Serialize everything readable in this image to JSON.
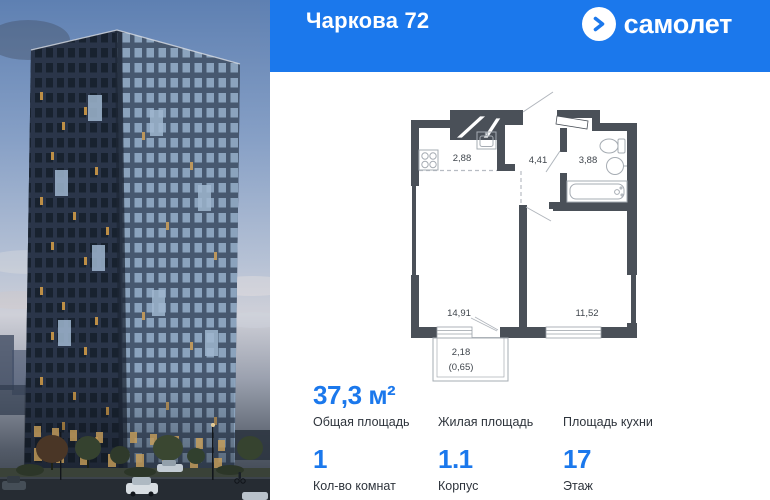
{
  "header": {
    "title": "Чаркова 72",
    "logo_text": "самолет"
  },
  "colors": {
    "accent": "#1b78ec",
    "wall": "#4a5058",
    "text_dark": "#2e343c"
  },
  "floorplan": {
    "rooms": [
      {
        "id": "kitchen-zone",
        "area": "2,88"
      },
      {
        "id": "hallway",
        "area": "4,41"
      },
      {
        "id": "bathroom",
        "area": "3,88"
      },
      {
        "id": "living-room",
        "area": "14,91"
      },
      {
        "id": "bedroom",
        "area": "11,52"
      },
      {
        "id": "balcony",
        "area": "2,18",
        "area_reduced": "(0,65)"
      }
    ]
  },
  "summary": {
    "row1": [
      {
        "value": "37,3 м²",
        "label": "Общая площадь"
      },
      {
        "value": "",
        "label": "Жилая площадь"
      },
      {
        "value": "",
        "label": "Площадь кухни"
      }
    ],
    "row2": [
      {
        "value": "1",
        "label": "Кол-во комнат"
      },
      {
        "value": "1.1",
        "label": "Корпус"
      },
      {
        "value": "17",
        "label": "Этаж"
      }
    ]
  }
}
